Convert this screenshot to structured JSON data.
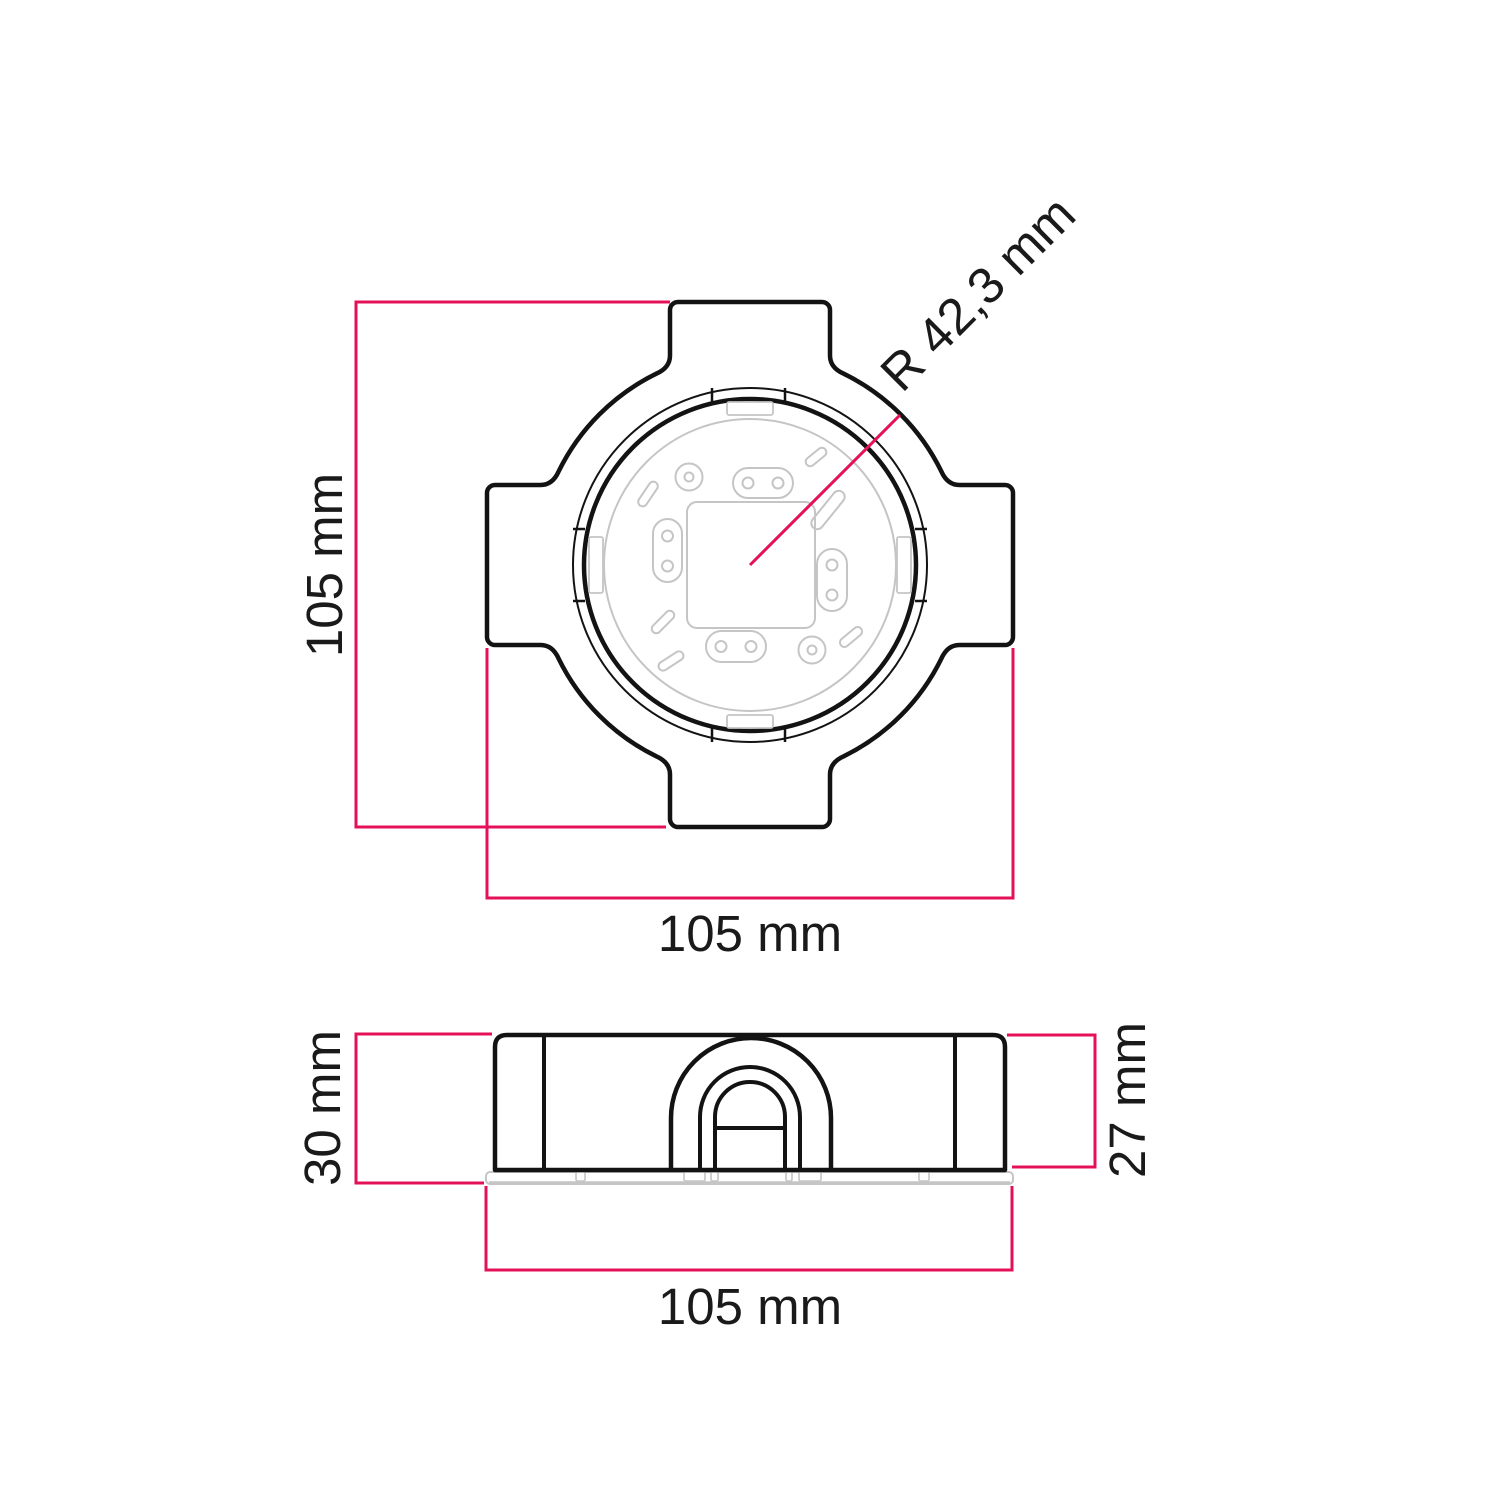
{
  "diagram": {
    "title": "junction-box dimension drawing",
    "top_view": {
      "height_label": "105 mm",
      "width_label": "105 mm",
      "radius_label": "R 42,3 mm",
      "height_mm": 105,
      "width_mm": 105,
      "radius_mm": 42.3
    },
    "side_view": {
      "total_height_label": "30 mm",
      "body_height_label": "27 mm",
      "width_label": "105 mm",
      "total_height_mm": 30,
      "body_height_mm": 27,
      "width_mm": 105
    },
    "colors": {
      "dimension_line": "#e5105a",
      "outline": "#131313",
      "detail_gray": "#c5c5c5",
      "text": "#1a1a1a",
      "background": "#ffffff"
    }
  }
}
